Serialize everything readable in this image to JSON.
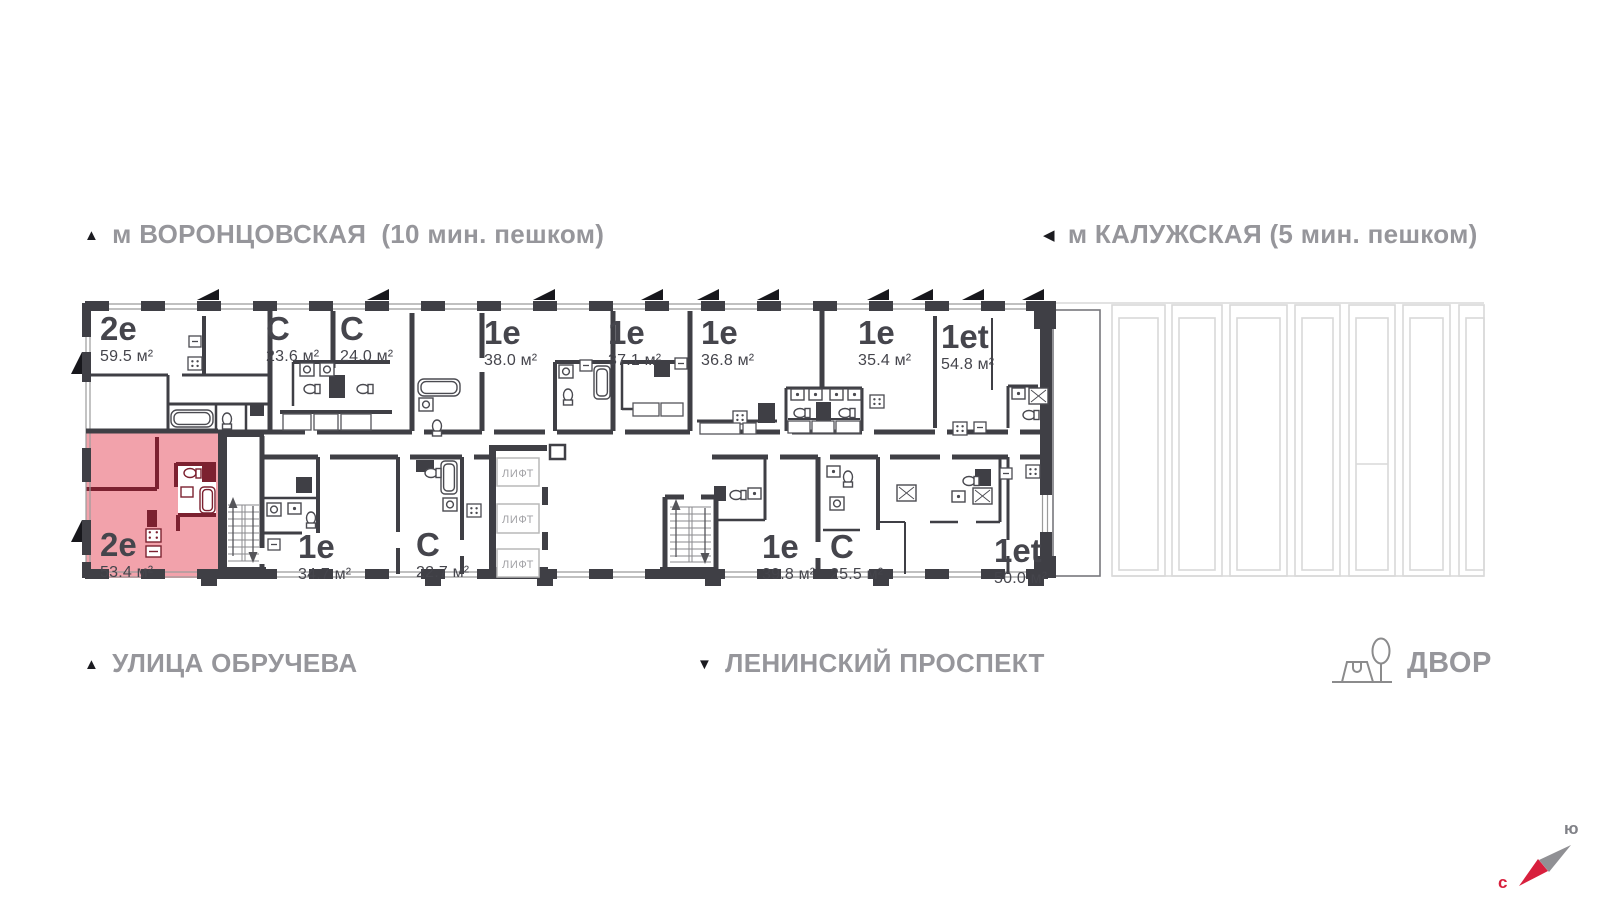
{
  "header": {
    "metro_left": {
      "marker": "▲",
      "label": "м ВОРОНЦОВСКАЯ  (10 мин. пешком)"
    },
    "metro_right": {
      "marker": "◀",
      "label": "м КАЛУЖСКАЯ (5 мин. пешком)"
    }
  },
  "footer": {
    "street_left": {
      "marker": "▲",
      "label": "УЛИЦА ОБРУЧЕВА"
    },
    "street_center": {
      "marker": "▼",
      "label": "ЛЕНИНСКИЙ ПРОСПЕКТ"
    },
    "yard_label": "ДВОР"
  },
  "compass": {
    "south": "ю",
    "north": "с",
    "north_color": "#d81f3d",
    "south_color": "#909094"
  },
  "plan": {
    "highlight_fill": "#f2a2ab",
    "highlight_wall": "#7c2130",
    "wall_color": "#3f3f45",
    "elevators": [
      {
        "label": "ЛИФТ"
      },
      {
        "label": "ЛИФТ"
      },
      {
        "label": "ЛИФТ"
      }
    ],
    "apartments": [
      {
        "type": "2е",
        "area": "59.5 м²",
        "highlighted": false
      },
      {
        "type": "С",
        "area": "23.6 м²",
        "highlighted": false
      },
      {
        "type": "С",
        "area": "24.0 м²",
        "highlighted": false
      },
      {
        "type": "1е",
        "area": "38.0 м²",
        "highlighted": false
      },
      {
        "type": "1е",
        "area": "37.1 м²",
        "highlighted": false
      },
      {
        "type": "1е",
        "area": "36.8 м²",
        "highlighted": false
      },
      {
        "type": "1е",
        "area": "35.4 м²",
        "highlighted": false
      },
      {
        "type": "1еt",
        "area": "54.8 м²",
        "highlighted": false
      },
      {
        "type": "2е",
        "area": "53.4 м²",
        "highlighted": true
      },
      {
        "type": "1е",
        "area": "34.7 м²",
        "highlighted": false
      },
      {
        "type": "С",
        "area": "22.7 м²",
        "highlighted": false
      },
      {
        "type": "1е",
        "area": "39.8 м²",
        "highlighted": false
      },
      {
        "type": "С",
        "area": "25.5 м²",
        "highlighted": false
      },
      {
        "type": "1еt",
        "area": "50.0 м²",
        "highlighted": false
      }
    ]
  }
}
